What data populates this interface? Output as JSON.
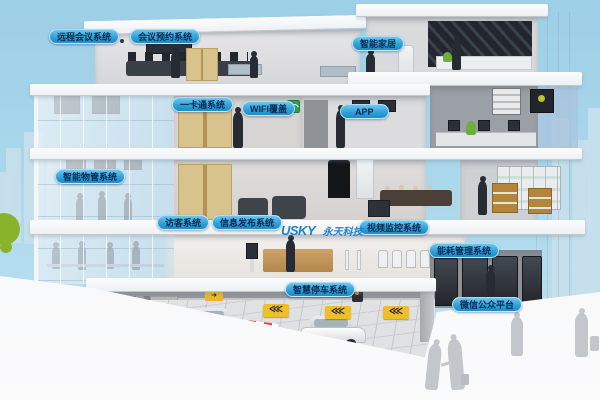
{
  "labels": [
    {
      "id": "remote-conference",
      "text": "远程会议系统"
    },
    {
      "id": "meeting-reservation",
      "text": "会议预约系统"
    },
    {
      "id": "smart-home",
      "text": "智能家居"
    },
    {
      "id": "one-card",
      "text": "一卡通系统"
    },
    {
      "id": "wifi-coverage",
      "text": "WIFI覆盖"
    },
    {
      "id": "app",
      "text": "APP"
    },
    {
      "id": "property-management",
      "text": "智能物管系统"
    },
    {
      "id": "visitor",
      "text": "访客系统"
    },
    {
      "id": "info-publishing",
      "text": "信息发布系统"
    },
    {
      "id": "video-surveillance",
      "text": "视频监控系统"
    },
    {
      "id": "energy-management",
      "text": "能耗管理系统"
    },
    {
      "id": "smart-parking",
      "text": "智慧停车系统"
    },
    {
      "id": "wechat-platform",
      "text": "微信公众平台"
    }
  ],
  "logo": {
    "brand": "USKY",
    "company": "永天科技"
  },
  "icons": {
    "chevrons_left": "⋘",
    "arrow_right": "➜",
    "wifi_sign": "wifi-coverage-sign"
  },
  "colors": {
    "sky": "#a4d2e8",
    "badge_blue": "#2d9ed6",
    "badge_text": "#0a2a52",
    "logo_blue": "#1b7fd2",
    "sign_yellow": "#efbe2b",
    "bush_green": "#8ab32c",
    "barrier_red": "#d2483e"
  }
}
